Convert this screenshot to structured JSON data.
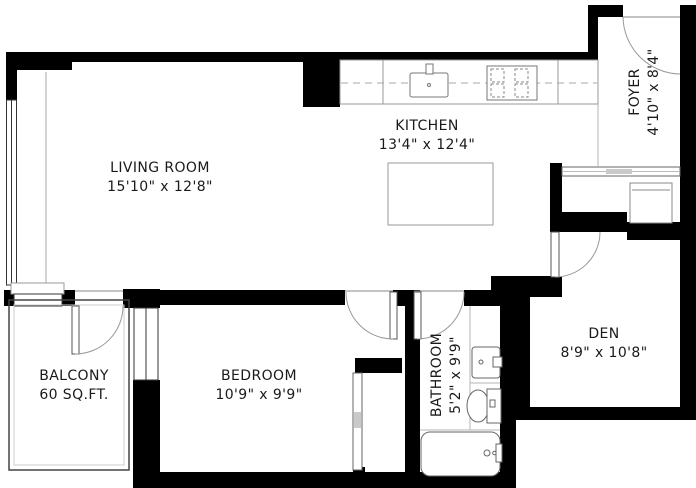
{
  "rooms": {
    "living_room": {
      "name": "LIVING ROOM",
      "dims": "15'10\" x 12'8\""
    },
    "kitchen": {
      "name": "KITCHEN",
      "dims": "13'4\" x 12'4\""
    },
    "foyer": {
      "name": "FOYER",
      "dims": "4'10\" x 8'4\""
    },
    "den": {
      "name": "DEN",
      "dims": "8'9\" x 10'8\""
    },
    "bedroom": {
      "name": "BEDROOM",
      "dims": "10'9\" x 9'9\""
    },
    "bathroom": {
      "name": "BATHROOM",
      "dims": "5'2\" x 9'9\""
    },
    "balcony": {
      "name": "BALCONY",
      "area": "60 SQ.FT."
    }
  },
  "colors": {
    "wall": "#000000",
    "fixture_line": "#6e6e6e",
    "thin_line": "#b5b5b5",
    "text": "#1a1a1a",
    "background": "#ffffff"
  }
}
